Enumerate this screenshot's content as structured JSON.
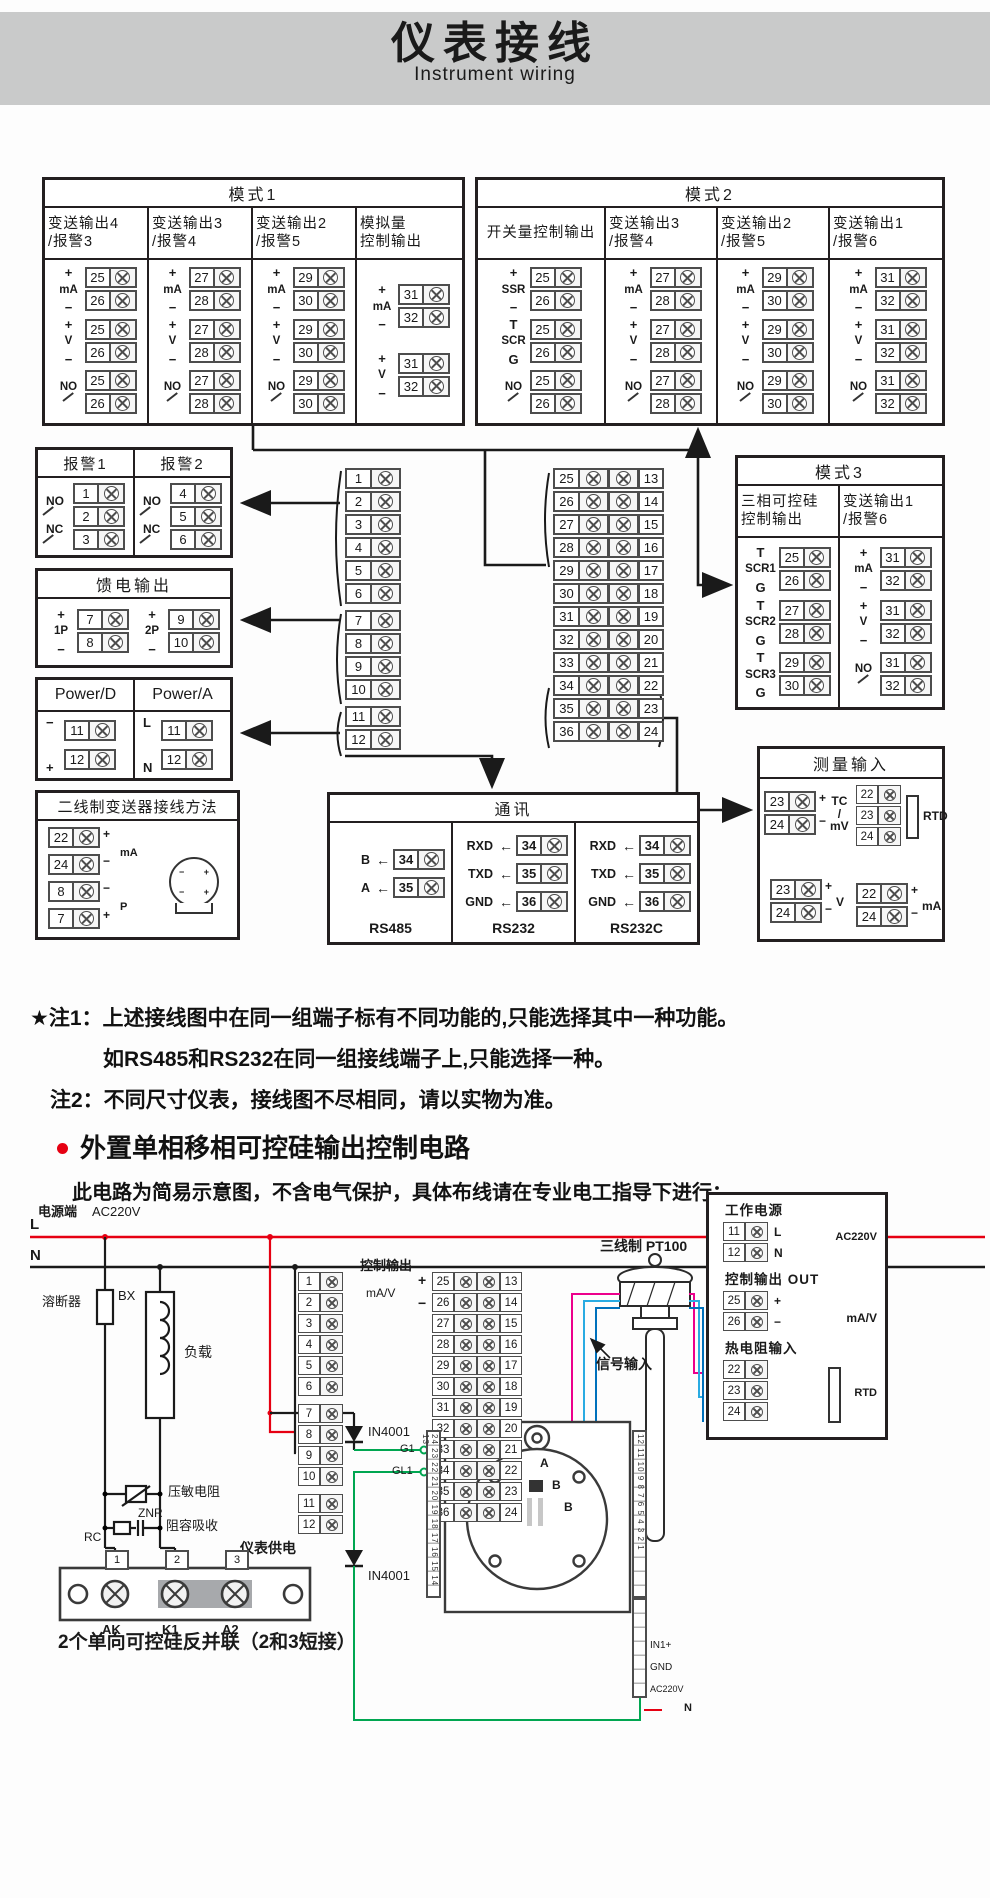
{
  "header": {
    "title": "仪表接线",
    "subtitle": "Instrument wiring"
  },
  "mode_boxes": [
    {
      "id": "mode1",
      "title": "模式1",
      "columns": [
        {
          "header": [
            "变送输出4",
            "/报警3"
          ],
          "groups": [
            {
              "name": "mA",
              "top": "+",
              "bot": "−",
              "terms": [
                "25",
                "26"
              ]
            },
            {
              "name": "V",
              "top": "+",
              "bot": "−",
              "terms": [
                "25",
                "26"
              ]
            },
            {
              "name": "NO",
              "top": "",
              "bot": "",
              "sw": true,
              "terms": [
                "25",
                "26"
              ]
            }
          ]
        },
        {
          "header": [
            "变送输出3",
            "/报警4"
          ],
          "groups": [
            {
              "name": "mA",
              "top": "+",
              "bot": "−",
              "terms": [
                "27",
                "28"
              ]
            },
            {
              "name": "V",
              "top": "+",
              "bot": "−",
              "terms": [
                "27",
                "28"
              ]
            },
            {
              "name": "NO",
              "top": "",
              "bot": "",
              "sw": true,
              "terms": [
                "27",
                "28"
              ]
            }
          ]
        },
        {
          "header": [
            "变送输出2",
            "/报警5"
          ],
          "groups": [
            {
              "name": "mA",
              "top": "+",
              "bot": "−",
              "terms": [
                "29",
                "30"
              ]
            },
            {
              "name": "V",
              "top": "+",
              "bot": "−",
              "terms": [
                "29",
                "30"
              ]
            },
            {
              "name": "NO",
              "top": "",
              "bot": "",
              "sw": true,
              "terms": [
                "29",
                "30"
              ]
            }
          ]
        },
        {
          "header": [
            "模拟量",
            "控制输出"
          ],
          "groups": [
            {
              "name": "mA",
              "top": "+",
              "bot": "−",
              "terms": [
                "31",
                "32"
              ]
            },
            {
              "name": "V",
              "top": "+",
              "bot": "−",
              "terms": [
                "31",
                "32"
              ]
            }
          ]
        }
      ]
    },
    {
      "id": "mode2",
      "title": "模式2",
      "columns": [
        {
          "header": [
            "开关量控制输出"
          ],
          "groups": [
            {
              "name": "SSR",
              "top": "+",
              "bot": "−",
              "terms": [
                "25",
                "26"
              ]
            },
            {
              "name": "SCR",
              "top": "T",
              "bot": "G",
              "terms": [
                "25",
                "26"
              ]
            },
            {
              "name": "NO",
              "top": "",
              "bot": "",
              "sw": true,
              "terms": [
                "25",
                "26"
              ]
            }
          ]
        },
        {
          "header": [
            "变送输出3",
            "/报警4"
          ],
          "groups": [
            {
              "name": "mA",
              "top": "+",
              "bot": "−",
              "terms": [
                "27",
                "28"
              ]
            },
            {
              "name": "V",
              "top": "+",
              "bot": "−",
              "terms": [
                "27",
                "28"
              ]
            },
            {
              "name": "NO",
              "top": "",
              "bot": "",
              "sw": true,
              "terms": [
                "27",
                "28"
              ]
            }
          ]
        },
        {
          "header": [
            "变送输出2",
            "/报警5"
          ],
          "groups": [
            {
              "name": "mA",
              "top": "+",
              "bot": "−",
              "terms": [
                "29",
                "30"
              ]
            },
            {
              "name": "V",
              "top": "+",
              "bot": "−",
              "terms": [
                "29",
                "30"
              ]
            },
            {
              "name": "NO",
              "top": "",
              "bot": "",
              "sw": true,
              "terms": [
                "29",
                "30"
              ]
            }
          ]
        },
        {
          "header": [
            "变送输出1",
            "/报警6"
          ],
          "groups": [
            {
              "name": "mA",
              "top": "+",
              "bot": "−",
              "terms": [
                "31",
                "32"
              ]
            },
            {
              "name": "V",
              "top": "+",
              "bot": "−",
              "terms": [
                "31",
                "32"
              ]
            },
            {
              "name": "NO",
              "top": "",
              "bot": "",
              "sw": true,
              "terms": [
                "31",
                "32"
              ]
            }
          ]
        }
      ]
    },
    {
      "id": "mode3",
      "title": "模式3",
      "columns": [
        {
          "header": [
            "三相可控硅",
            "控制输出"
          ],
          "groups": [
            {
              "name": "SCR1",
              "top": "T",
              "bot": "G",
              "terms": [
                "25",
                "26"
              ]
            },
            {
              "name": "SCR2",
              "top": "T",
              "bot": "G",
              "terms": [
                "27",
                "28"
              ]
            },
            {
              "name": "SCR3",
              "top": "T",
              "bot": "G",
              "terms": [
                "29",
                "30"
              ]
            }
          ]
        },
        {
          "header": [
            "变送输出1",
            "/报警6"
          ],
          "groups": [
            {
              "name": "mA",
              "top": "+",
              "bot": "−",
              "terms": [
                "31",
                "32"
              ]
            },
            {
              "name": "V",
              "top": "+",
              "bot": "−",
              "terms": [
                "31",
                "32"
              ]
            },
            {
              "name": "NO",
              "top": "",
              "bot": "",
              "sw": true,
              "terms": [
                "31",
                "32"
              ]
            }
          ]
        }
      ]
    }
  ],
  "alarm_box": {
    "titles": [
      "报警1",
      "报警2"
    ],
    "cols": [
      {
        "terms": [
          "1",
          "2",
          "3"
        ],
        "labels": [
          "NO",
          "NC"
        ]
      },
      {
        "terms": [
          "4",
          "5",
          "6"
        ],
        "labels": [
          "NO",
          "NC"
        ]
      }
    ]
  },
  "feed_box": {
    "title": "馈电输出",
    "groups": [
      {
        "name": "1P",
        "top": "+",
        "bot": "−",
        "terms": [
          "7",
          "8"
        ]
      },
      {
        "name": "2P",
        "top": "+",
        "bot": "−",
        "terms": [
          "9",
          "10"
        ]
      }
    ]
  },
  "power_box": {
    "cols": [
      {
        "title": "Power/D",
        "rows": [
          {
            "sig": "−",
            "term": "11"
          },
          {
            "sig": "+",
            "term": "12"
          }
        ]
      },
      {
        "title": "Power/A",
        "rows": [
          {
            "sig": "L",
            "term": "11"
          },
          {
            "sig": "N",
            "term": "12"
          }
        ]
      }
    ]
  },
  "twowire_box": {
    "title": "二线制变送器接线方法",
    "rows": [
      {
        "term": "22",
        "sig": "+",
        "note": "mA"
      },
      {
        "term": "24",
        "sig": "−",
        "note": ""
      },
      {
        "term": "8",
        "sig": "−",
        "note": ""
      },
      {
        "term": "7",
        "sig": "+",
        "note": "P"
      }
    ]
  },
  "comm_box": {
    "title": "通讯",
    "arrow": "←",
    "cols": [
      {
        "name": "RS485",
        "rows": [
          {
            "sig": "B",
            "term": "34"
          },
          {
            "sig": "A",
            "term": "35"
          }
        ]
      },
      {
        "name": "RS232",
        "rows": [
          {
            "sig": "RXD",
            "term": "34"
          },
          {
            "sig": "TXD",
            "term": "35"
          },
          {
            "sig": "GND",
            "term": "36"
          }
        ]
      },
      {
        "name": "RS232C",
        "rows": [
          {
            "sig": "RXD",
            "term": "34"
          },
          {
            "sig": "TXD",
            "term": "35"
          },
          {
            "sig": "GND",
            "term": "36"
          }
        ]
      }
    ]
  },
  "measure_box": {
    "title": "测量输入",
    "groups": [
      {
        "label": "TC/mV",
        "rows": [
          {
            "term": "23",
            "sig": "+"
          },
          {
            "term": "24",
            "sig": "−"
          }
        ]
      },
      {
        "label": "RTD",
        "rows": [
          {
            "term": "22"
          },
          {
            "term": "23"
          },
          {
            "term": "24"
          }
        ]
      },
      {
        "label": "V",
        "rows": [
          {
            "term": "23",
            "sig": "+"
          },
          {
            "term": "24",
            "sig": "−"
          }
        ]
      },
      {
        "label": "mA",
        "rows": [
          {
            "term": "22",
            "sig": "+"
          },
          {
            "term": "24",
            "sig": "−"
          }
        ]
      }
    ]
  },
  "strips": {
    "left": [
      "1",
      "2",
      "3",
      "4",
      "5",
      "6",
      "7",
      "8",
      "9",
      "10",
      "11",
      "12"
    ],
    "right_left": [
      "25",
      "26",
      "27",
      "28",
      "29",
      "30",
      "31",
      "32",
      "33",
      "34",
      "35",
      "36"
    ],
    "right_right": [
      "13",
      "14",
      "15",
      "16",
      "17",
      "18",
      "19",
      "20",
      "21",
      "22",
      "23",
      "24"
    ]
  },
  "notes": {
    "note1a": "★注1：上述接线图中在同一组端子标有不同功能的,只能选择其中一种功能。",
    "note1b": "如RS485和RS232在同一组接线端子上,只能选择一种。",
    "note2": "注2：不同尺寸仪表，接线图不尽相同，请以实物为准。"
  },
  "section2": {
    "heading": "外置单相移相可控硅输出控制电路",
    "subtitle": "此电路为简易示意图，不含电气保护，具体布线请在专业电工指导下进行；"
  },
  "circuit": {
    "power_label": "电源端",
    "power_v": "AC220V",
    "l": "L",
    "n": "N",
    "fuse": "溶断器",
    "fuse_code": "BX",
    "load": "负载",
    "znr_label": "压敏电阻",
    "znr": "ZNR",
    "rc_label": "阻容吸收",
    "rc": "RC",
    "scr_terms": [
      "1",
      "2",
      "3"
    ],
    "scr_names": [
      "AK",
      "K1",
      "A2"
    ],
    "scr_caption": "2个单向可控硅反并联（2和3短接）",
    "d1": "IN4001",
    "d2": "IN4001",
    "meter_supply": "仪表供电",
    "ctrl_out": "控制输出",
    "ctrl_plus": "+",
    "ctrl_sig": "mA/V",
    "ctrl_minus": "−",
    "pt100": "三线制 PT100",
    "wa": "A",
    "wb1": "B",
    "wb2": "B",
    "signal_in": "信号输入",
    "g1": "G1",
    "gl1": "GL1",
    "in1": "IN1+",
    "gnd": "GND",
    "ac_b": "AC220V",
    "n_b": "N",
    "conn_left": "24 23 22 21 20 19 18 17 16 15 14 13",
    "conn_right": "12 11 10 9 8 7 6 5 4 3 2 1",
    "legend": {
      "work_title": "工作电源",
      "work_rows": [
        {
          "term": "11",
          "sig": "L"
        },
        {
          "term": "12",
          "sig": "N"
        }
      ],
      "ac": "AC220V",
      "ctrl_title": "控制输出 OUT",
      "ctrl_rows": [
        {
          "term": "25",
          "sig": "+"
        },
        {
          "term": "26",
          "sig": "−"
        }
      ],
      "ctrl_sig": "mA/V",
      "rtd_title": "热电阻输入",
      "rtd_rows": [
        {
          "term": "22"
        },
        {
          "term": "23"
        },
        {
          "term": "24"
        }
      ],
      "rtd": "RTD"
    },
    "colors": {
      "line_red": "#e60012",
      "green": "#00a651",
      "magenta": "#ec008c",
      "cyan": "#29abe2",
      "blue": "#0071bc"
    }
  }
}
